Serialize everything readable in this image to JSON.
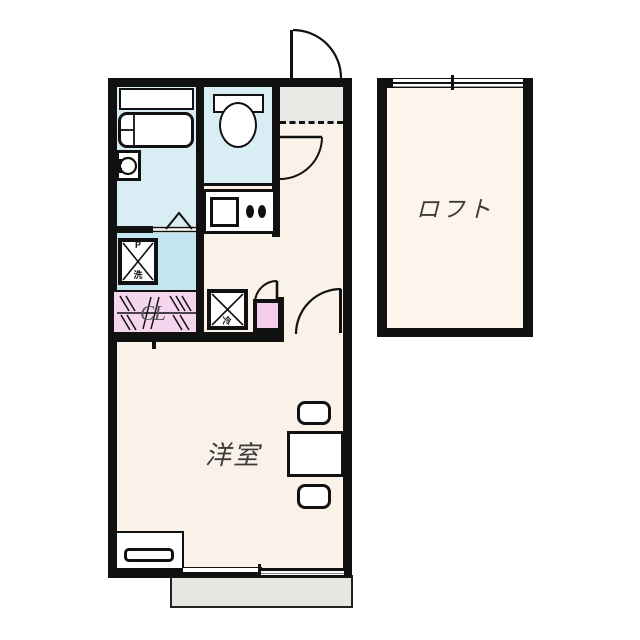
{
  "floorplan": {
    "title": "apartment-floor-plan",
    "rooms": {
      "loft": {
        "label": "ロフト"
      },
      "western_room": {
        "label": "洋室"
      },
      "closet": {
        "label": "CL"
      },
      "bathroom": {
        "label": ""
      },
      "toilet": {
        "label": ""
      },
      "entrance": {
        "label": ""
      }
    },
    "fixtures": {
      "washing_machine_pan": {
        "label_top": "P",
        "label_bottom": "洗"
      },
      "refrigerator_space": {
        "label": "冷"
      }
    },
    "colors": {
      "wall": "#111111",
      "bathroom_floor": "#d8eef4",
      "washing_area_floor": "#c2e5f0",
      "toilet_floor": "#d8eef4",
      "closet_pink": "#f6d6ee",
      "vanity_pink": "#f3cdec",
      "entrance_tile": "#e9e8e4",
      "balcony_gray": "#e6e6e3",
      "room_floor": "#faf1e8",
      "loft_floor": "#fdf4ec",
      "label_text": "#3b3b3b"
    }
  }
}
